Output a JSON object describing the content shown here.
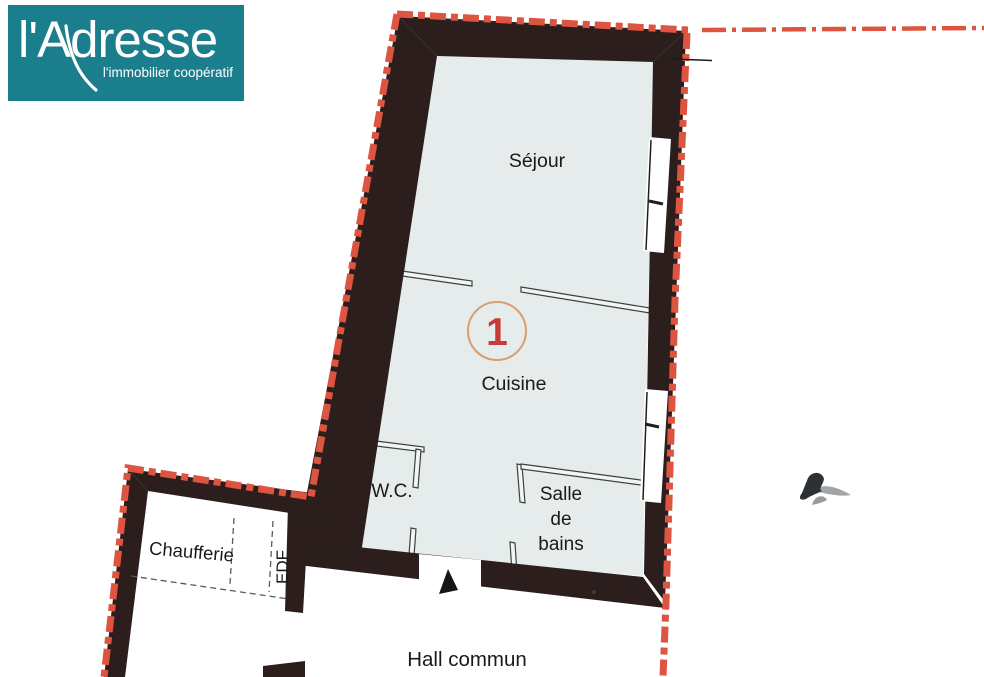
{
  "logo": {
    "brand": "l'Adresse",
    "tagline": "l'immobilier coopératif",
    "background_color": "#1b7e8d",
    "text_color": "#ffffff"
  },
  "floor_plan": {
    "unit_number": "1",
    "rooms": {
      "sejour": {
        "label": "Séjour"
      },
      "cuisine": {
        "label": "Cuisine"
      },
      "wc": {
        "label": "W.C."
      },
      "salle_de_bains": {
        "lines": [
          "Salle",
          "de",
          "bains"
        ]
      },
      "chaufferie": {
        "label": "Chaufferie"
      },
      "edf": {
        "label": "EDF"
      },
      "hall_commun": {
        "label": "Hall commun"
      }
    },
    "colors": {
      "wall": "#2b1e1c",
      "floor": "#e5eceb",
      "boundary_line": "#dd5540",
      "partition_line": "#39443a",
      "unit_circle": "#d89e6e",
      "unit_number_red": "#c63c38",
      "label_text": "#1a1a1a"
    }
  }
}
